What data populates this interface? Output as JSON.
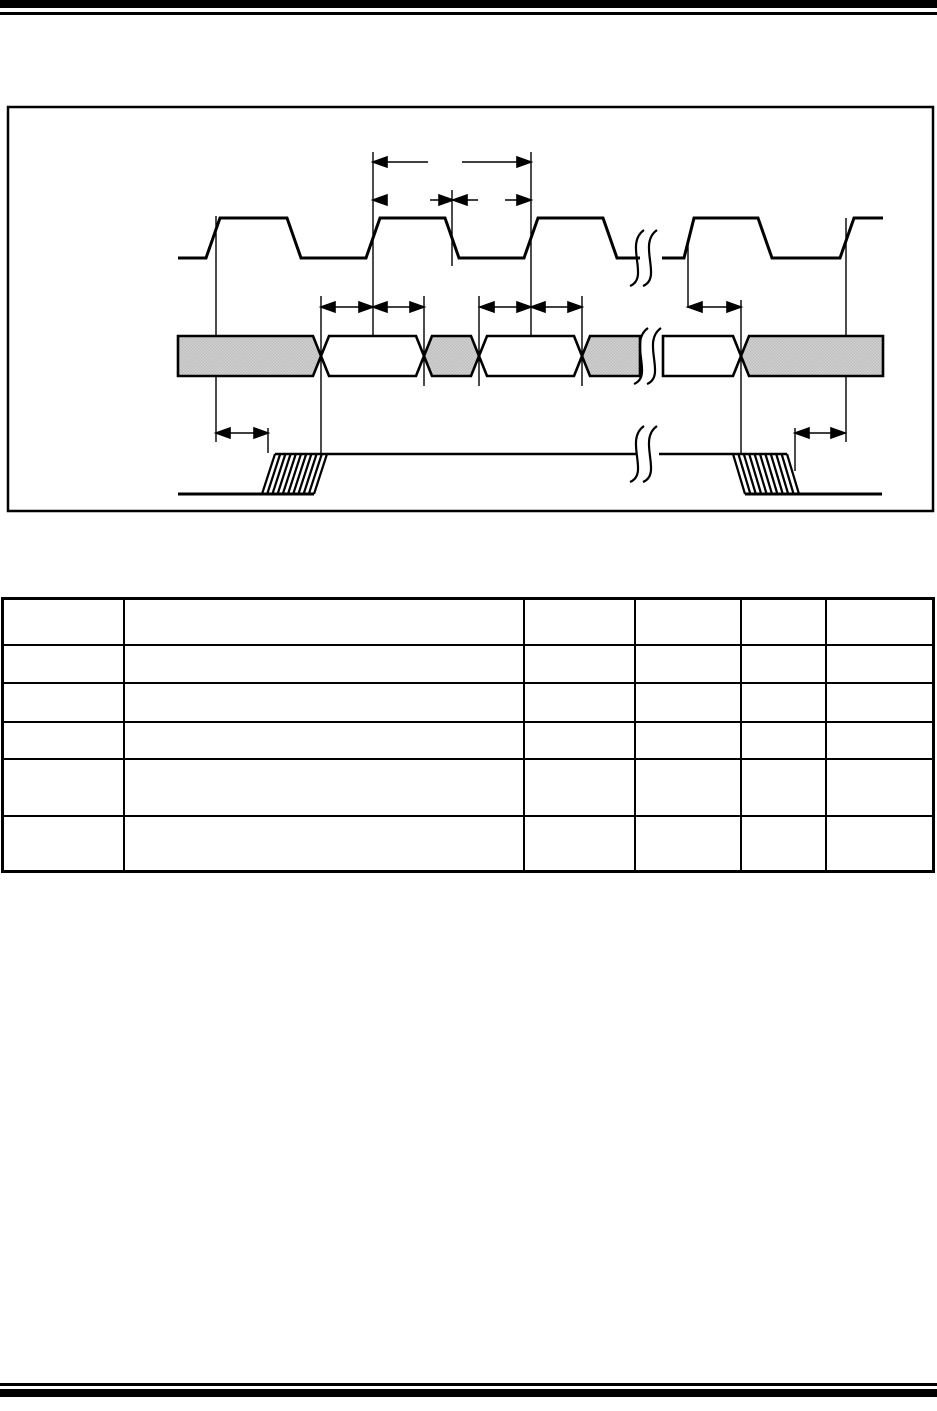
{
  "page": {
    "width_px": 937,
    "height_px": 1411,
    "background_color": "#ffffff",
    "rule_color": "#000000",
    "top_rules": {
      "thick_height_px": 8,
      "thin_height_px": 3
    },
    "bottom_rules": {
      "thin_height_px": 3,
      "thick_height_px": 8
    }
  },
  "figure": {
    "type": "timing-diagram",
    "border_color": "#000000",
    "ink_color": "#000000",
    "shaded_fill_light": "#d2d2d2",
    "shaded_fill_dark": "#bdbdbd",
    "caption": "",
    "waveforms": [
      {
        "role": "clock",
        "label": "",
        "pulses_visible": 5,
        "has_break_mark": true
      },
      {
        "role": "data-bus",
        "label": "",
        "has_break_mark": true,
        "segment_fills": [
          "shaded",
          "white",
          "shaded",
          "white",
          "shaded",
          "white",
          "shaded"
        ]
      },
      {
        "role": "enable",
        "label": "",
        "has_break_mark": true,
        "edges": [
          "hatched-rise",
          "hatched-fall"
        ]
      }
    ],
    "dimension_arrows": {
      "count": 9,
      "labels": [
        "",
        "",
        "",
        "",
        "",
        "",
        "",
        "",
        ""
      ]
    }
  },
  "table": {
    "border_color": "#000000",
    "columns": 6,
    "data_row_count": 5,
    "header": [
      "",
      "",
      "",
      "",
      "",
      ""
    ],
    "rows": [
      [
        "",
        "",
        "",
        "",
        "",
        ""
      ],
      [
        "",
        "",
        "",
        "",
        "",
        ""
      ],
      [
        "",
        "",
        "",
        "",
        "",
        ""
      ],
      [
        "",
        "",
        "",
        "",
        "",
        ""
      ],
      [
        "",
        "",
        "",
        "",
        "",
        ""
      ]
    ]
  }
}
